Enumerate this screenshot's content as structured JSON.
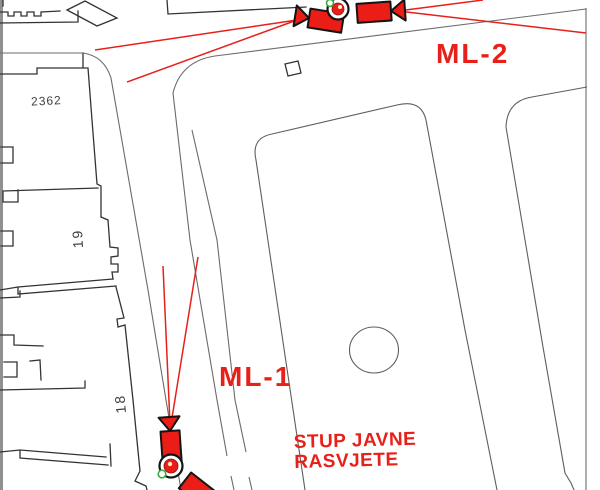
{
  "map": {
    "title_context": "site plan with CCTV camera locations",
    "labels": {
      "parcel_2362": "2362",
      "house_19": "19",
      "house_18": "18",
      "camera_ml2": "ML-2",
      "camera_ml1": "ML-1",
      "pole_note_line1": "STUP JAVNE",
      "pole_note_line2": "RASVJETE"
    },
    "colors": {
      "annotation_red": "#e8201a",
      "camera_fill": "#ec1c16",
      "pole_green": "#3cab3c",
      "building_line": "#333333",
      "street_line": "#6b6b6b"
    },
    "icons": {
      "camera": "cctv-camera-icon",
      "pole": "lighting-pole-icon"
    }
  }
}
